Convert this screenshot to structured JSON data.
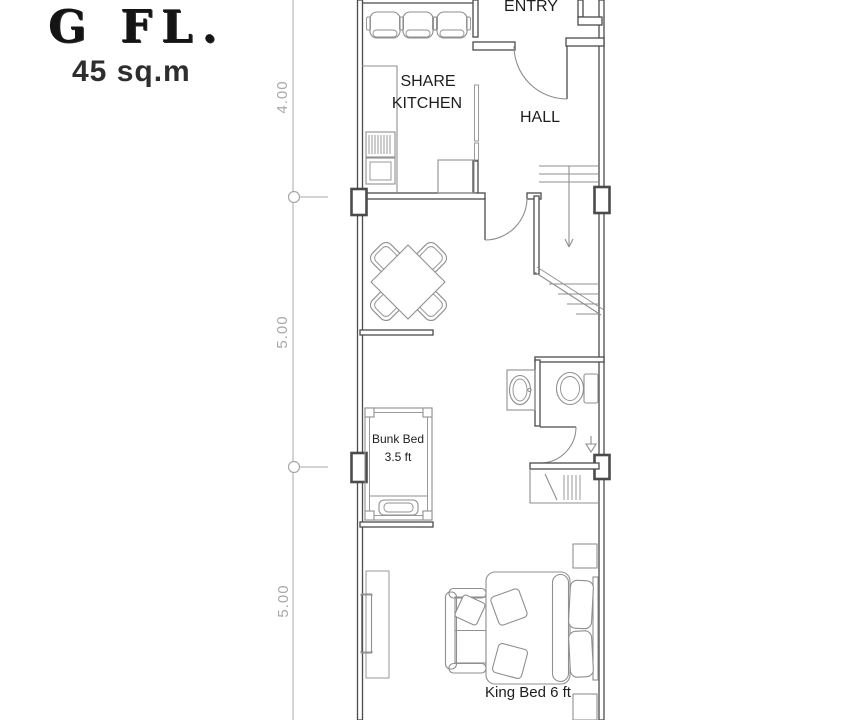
{
  "colors": {
    "wall": "#4b4b4b",
    "furn": "#8f8f8f",
    "dim": "#a8a8a8",
    "ink": "#1d1d1d",
    "paper": "#ffffff"
  },
  "title": {
    "floor_label": "G FL.",
    "area_label": "45 sq.m"
  },
  "dimension_marks": {
    "top": "4.00",
    "middle": "5.00",
    "bottom": "5.00"
  },
  "room_labels": {
    "entry": "ENTRY",
    "hall": "HALL",
    "share_kitchen_line1": "SHARE",
    "share_kitchen_line2": "KITCHEN"
  },
  "furniture_labels": {
    "bunk_bed_line1": "Bunk Bed",
    "bunk_bed_line2": "3.5 ft",
    "king_bed": "King Bed 6 ft"
  }
}
